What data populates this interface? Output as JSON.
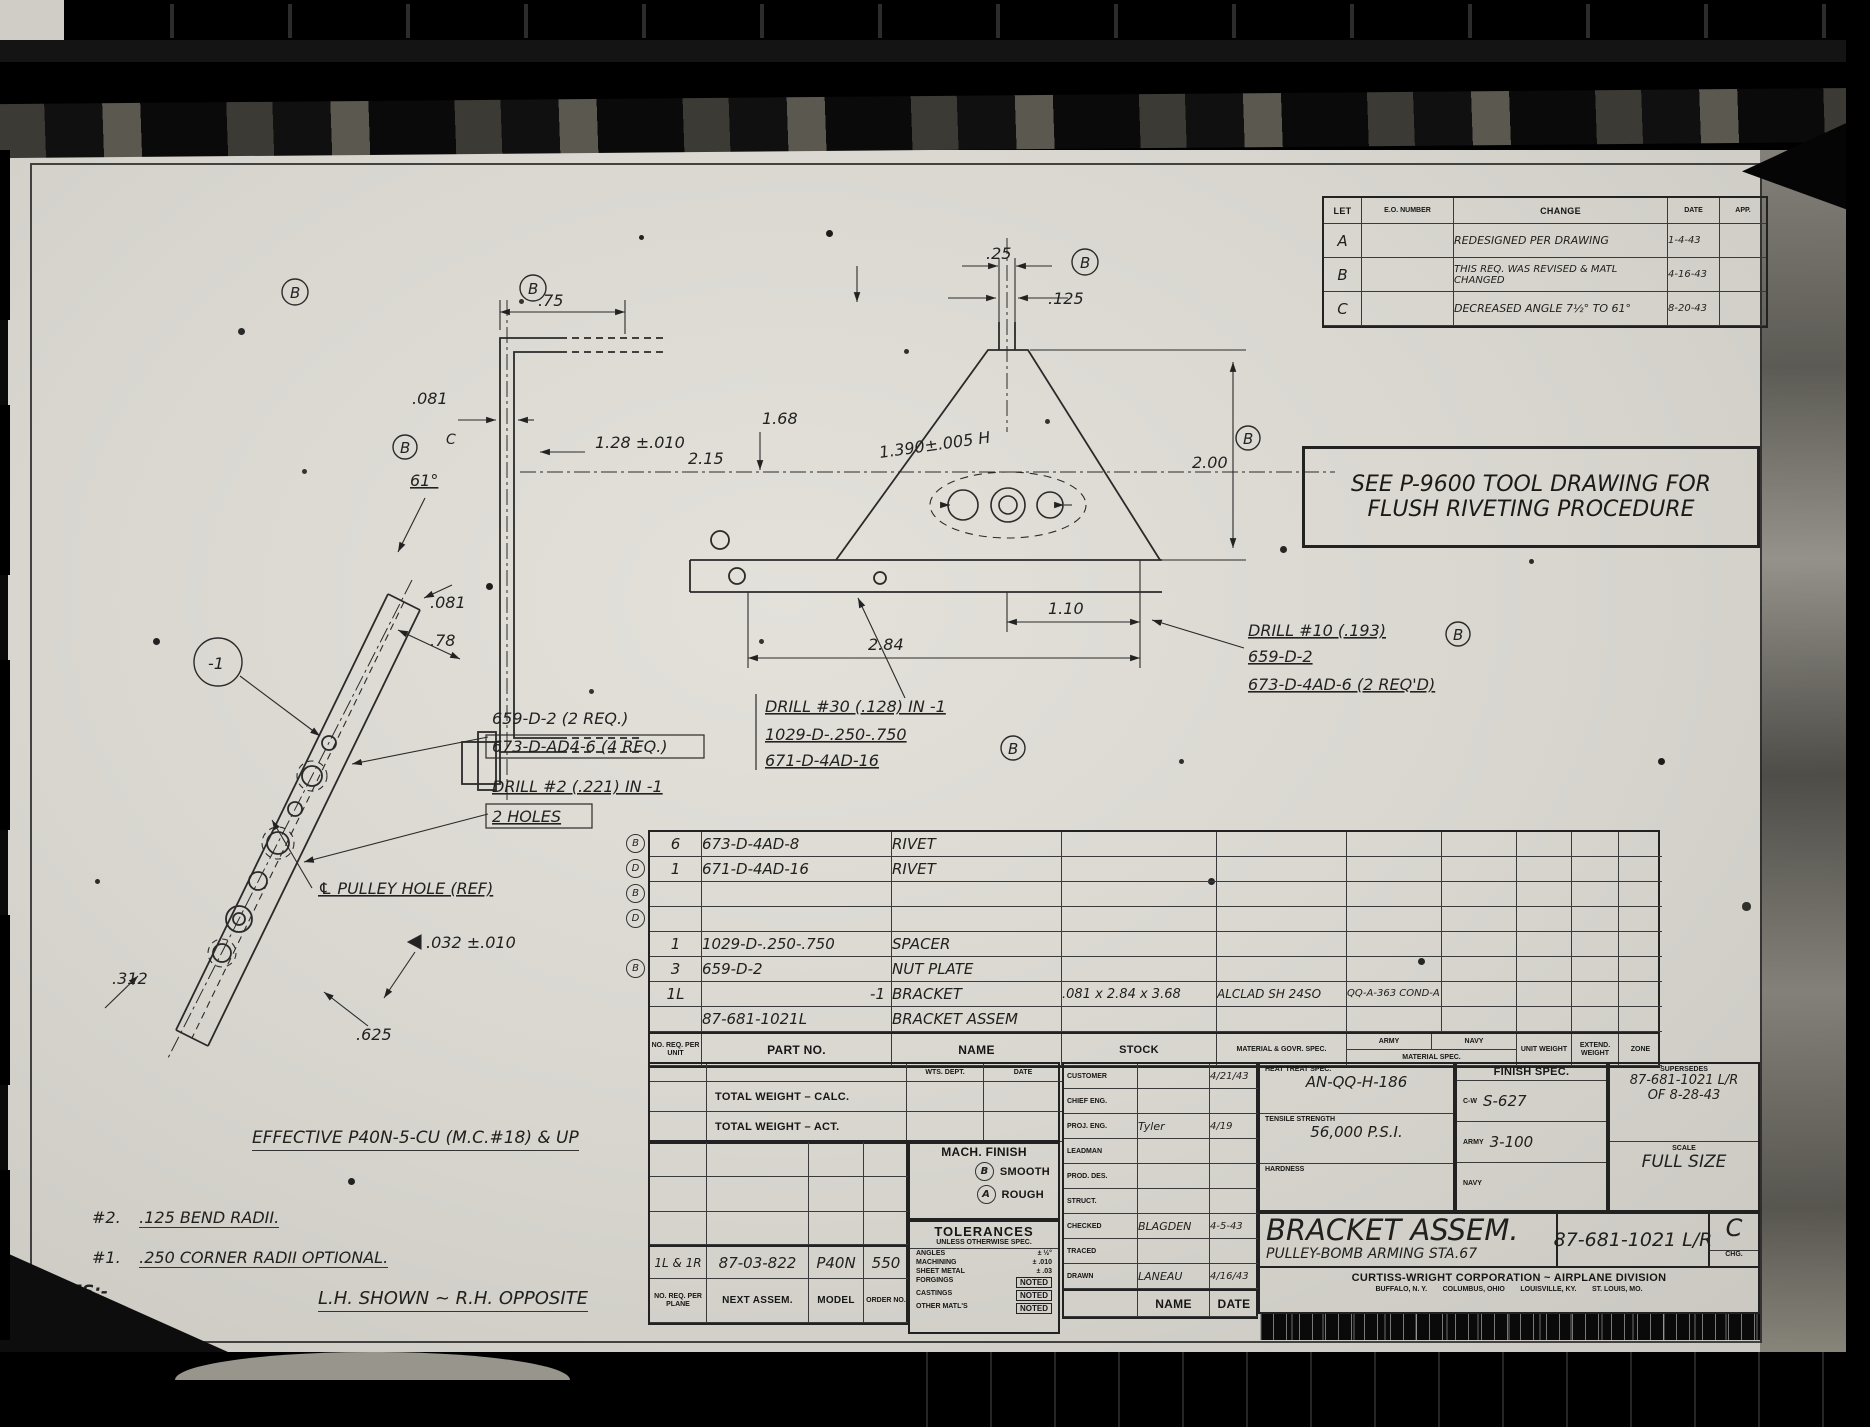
{
  "sheet": {
    "note_box_line1": "SEE P-9600 TOOL DRAWING FOR",
    "note_box_line2": "FLUSH RIVETING PROCEDURE",
    "stamp": "No. 100-1     2-43-10"
  },
  "rev_table": {
    "headers": {
      "let": "LET",
      "eo": "E.O. NUMBER",
      "change": "CHANGE",
      "date": "DATE",
      "app": "APP."
    },
    "rows": [
      {
        "let": "A",
        "eo": "",
        "change": "REDESIGNED PER DRAWING",
        "date": "1-4-43",
        "app": ""
      },
      {
        "let": "B",
        "eo": "",
        "change": "THIS REQ. WAS REVISED & MATL CHANGED",
        "date": "4-16-43",
        "app": ""
      },
      {
        "let": "C",
        "eo": "",
        "change": "DECREASED ANGLE 7½° TO 61°",
        "date": "8-20-43",
        "app": ""
      }
    ]
  },
  "dims": {
    "d25": ".25",
    "d125": ".125",
    "d75": ".75",
    "d081a": ".081",
    "d128": "1.28 ±.010",
    "d168": "1.68",
    "d215": "2.15",
    "d61": "61°",
    "d1390": "1.390±.005 H",
    "d200": "2.00",
    "d110": "1.10",
    "d284": "2.84",
    "d081c": ".081",
    "d78": ".78",
    "d312": ".312",
    "d625": ".625",
    "d032": ".032 ±.010",
    "b": "B",
    "c": "C"
  },
  "callouts": {
    "group_left_l1": "659-D-2 (2 REQ.)",
    "group_left_l2": "673-D-AD4-6 (4 REQ.)",
    "drill2_l1": "DRILL #2 (.221) IN -1",
    "drill2_l2": "2 HOLES",
    "drill30_l1": "DRILL #30 (.128) IN -1",
    "drill30_l2": "1029-D-.250-.750",
    "drill30_l3": "671-D-4AD-16",
    "drill10_l1": "DRILL #10 (.193)",
    "drill10_l2": "659-D-2",
    "drill10_l3": "673-D-4AD-6 (2 REQ'D)",
    "pulley": "℄ PULLEY HOLE (REF)",
    "balloon": "-1"
  },
  "parts": {
    "headers": {
      "qty": "NO. REQ. PER UNIT",
      "part": "PART NO.",
      "name": "NAME",
      "stock": "STOCK",
      "material": "MATERIAL & GOVR. SPEC.",
      "matspec": "MATERIAL SPEC.",
      "army": "ARMY",
      "navy": "NAVY",
      "unit": "UNIT WEIGHT",
      "extend": "EXTEND. WEIGHT",
      "zone": "ZONE"
    },
    "rows": [
      {
        "flag": "B",
        "qty": "6",
        "part": "673-D-4AD-8",
        "name": "RIVET",
        "stock": "",
        "material": "",
        "army": ""
      },
      {
        "flag": "D",
        "qty": "1",
        "part": "671-D-4AD-16",
        "name": "RIVET",
        "stock": "",
        "material": "",
        "army": ""
      },
      {
        "flag": "B",
        "qty": "",
        "part": "",
        "name": "",
        "stock": "",
        "material": "",
        "army": ""
      },
      {
        "flag": "D",
        "qty": "",
        "part": "",
        "name": "",
        "stock": "",
        "material": "",
        "army": ""
      },
      {
        "flag": "",
        "qty": "1",
        "part": "1029-D-.250-.750",
        "name": "SPACER",
        "stock": "",
        "material": "",
        "army": ""
      },
      {
        "flag": "B",
        "qty": "3",
        "part": "659-D-2",
        "name": "NUT PLATE",
        "stock": "",
        "material": "",
        "army": ""
      },
      {
        "flag": "",
        "qty": "1L",
        "part": "-1",
        "name": "BRACKET",
        "stock": ".081 x 2.84 x 3.68",
        "material": "ALCLAD SH 24SO",
        "army": "QQ-A-363 COND-A"
      },
      {
        "flag": "",
        "qty": "",
        "part": "87-681-1021L",
        "name": "BRACKET ASSEM",
        "stock": "",
        "material": "",
        "army": ""
      }
    ]
  },
  "weights": {
    "wts_dept": "WTS. DEPT.",
    "date": "DATE",
    "calc": "TOTAL WEIGHT – CALC.",
    "act": "TOTAL WEIGHT – ACT."
  },
  "mach": {
    "title": "MACH. FINISH",
    "b": "B",
    "smooth": "SMOOTH",
    "a": "A",
    "rough": "ROUGH"
  },
  "tol": {
    "title": "TOLERANCES",
    "subtitle": "UNLESS OTHERWISE SPEC.",
    "items": [
      {
        "label": "ANGLES",
        "value": "± ½°"
      },
      {
        "label": "MACHINING",
        "value": "± .010"
      },
      {
        "label": "SHEET METAL",
        "value": "± .03"
      },
      {
        "label": "FORGINGS",
        "value": "NOTED"
      },
      {
        "label": "CASTINGS",
        "value": "NOTED"
      },
      {
        "label": "OTHER MATL'S",
        "value": "NOTED"
      }
    ]
  },
  "signoff": {
    "rows": [
      {
        "label": "CUSTOMER",
        "name": "",
        "date": "4/21/43"
      },
      {
        "label": "CHIEF ENG.",
        "name": "",
        "date": ""
      },
      {
        "label": "PROJ. ENG.",
        "name": "Tyler",
        "date": "4/19"
      },
      {
        "label": "LEADMAN",
        "name": "",
        "date": ""
      },
      {
        "label": "PROD. DES.",
        "name": "",
        "date": ""
      },
      {
        "label": "STRUCT.",
        "name": "",
        "date": ""
      },
      {
        "label": "CHECKED",
        "name": "BLAGDEN",
        "date": "4-5-43"
      },
      {
        "label": "TRACED",
        "name": "",
        "date": ""
      },
      {
        "label": "DRAWN",
        "name": "LANEAU",
        "date": "4/16/43"
      }
    ],
    "foot_name": "NAME",
    "foot_date": "DATE"
  },
  "specs": {
    "heat_label": "HEAT TREAT SPEC.",
    "heat": "AN-QQ-H-186",
    "tensile_label": "TENSILE STRENGTH",
    "tensile": "56,000 P.S.I.",
    "hard_label": "HARDNESS",
    "hard": "",
    "finish_label": "FINISH SPEC.",
    "cw_label": "C-W",
    "cw": "S-627",
    "army_label": "ARMY",
    "army": "3-100",
    "navy_label": "NAVY",
    "navy": "",
    "sup_label": "SUPERSEDES",
    "sup1": "87-681-1021 L/R",
    "sup2": "OF  8-28-43",
    "scale_label": "SCALE",
    "scale": "FULL SIZE"
  },
  "title_block": {
    "title": "BRACKET ASSEM.",
    "subtitle": "PULLEY-BOMB ARMING STA.67",
    "number": "87-681-1021 L/R",
    "rev": "C",
    "chg": "CHG.",
    "company": "CURTISS-WRIGHT CORPORATION ~ AIRPLANE DIVISION",
    "locations": "BUFFALO, N. Y.        COLUMBUS, OHIO        LOUISVILLE, KY.        ST. LOUIS, MO."
  },
  "usage": {
    "values": {
      "req": "1L & 1R",
      "next": "87-03-822",
      "model": "P40N",
      "order": "550"
    },
    "labels": {
      "req": "NO. REQ. PER PLANE",
      "next": "NEXT ASSEM.",
      "model": "MODEL",
      "order": "ORDER NO."
    }
  },
  "notes": {
    "effective": "EFFECTIVE P40N-5-CU (M.C.#18) & UP",
    "n2_tag": "#2.",
    "n2": ".125 BEND RADII.",
    "n1_tag": "#1.",
    "n1": ".250 CORNER RADII OPTIONAL.",
    "label": "NOTES:-",
    "lh": "L.H. SHOWN ~ R.H. OPPOSITE"
  }
}
